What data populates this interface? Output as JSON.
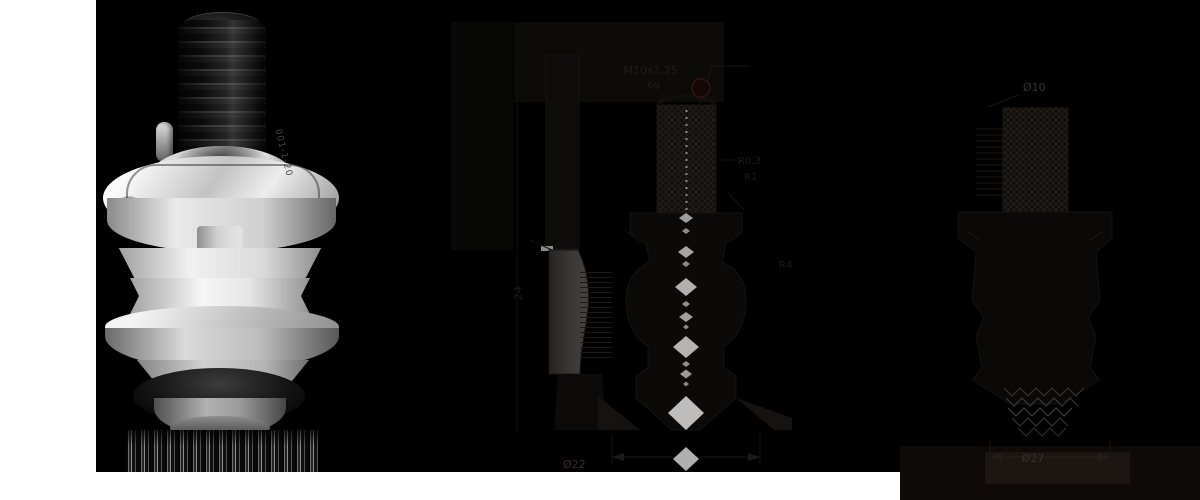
{
  "product": {
    "engraving": "001-1-20"
  },
  "drawing": {
    "thread_label": "M10x1,25",
    "thread_fit": "6g",
    "left_view": {
      "height_dim": "24"
    },
    "center_view": {
      "radius_label_1": "R0,3",
      "radius_label_2": "R1",
      "radius_label_3": "R4",
      "width_dim": "Ø22"
    },
    "right_view": {
      "stud_dia": "Ø10",
      "outer_dia": "Ø27"
    }
  },
  "colors": {
    "background": "#000000",
    "page_white": "#ffffff",
    "centerline_gray": "#a9a9a9",
    "balloon_red": "#2f1511"
  }
}
